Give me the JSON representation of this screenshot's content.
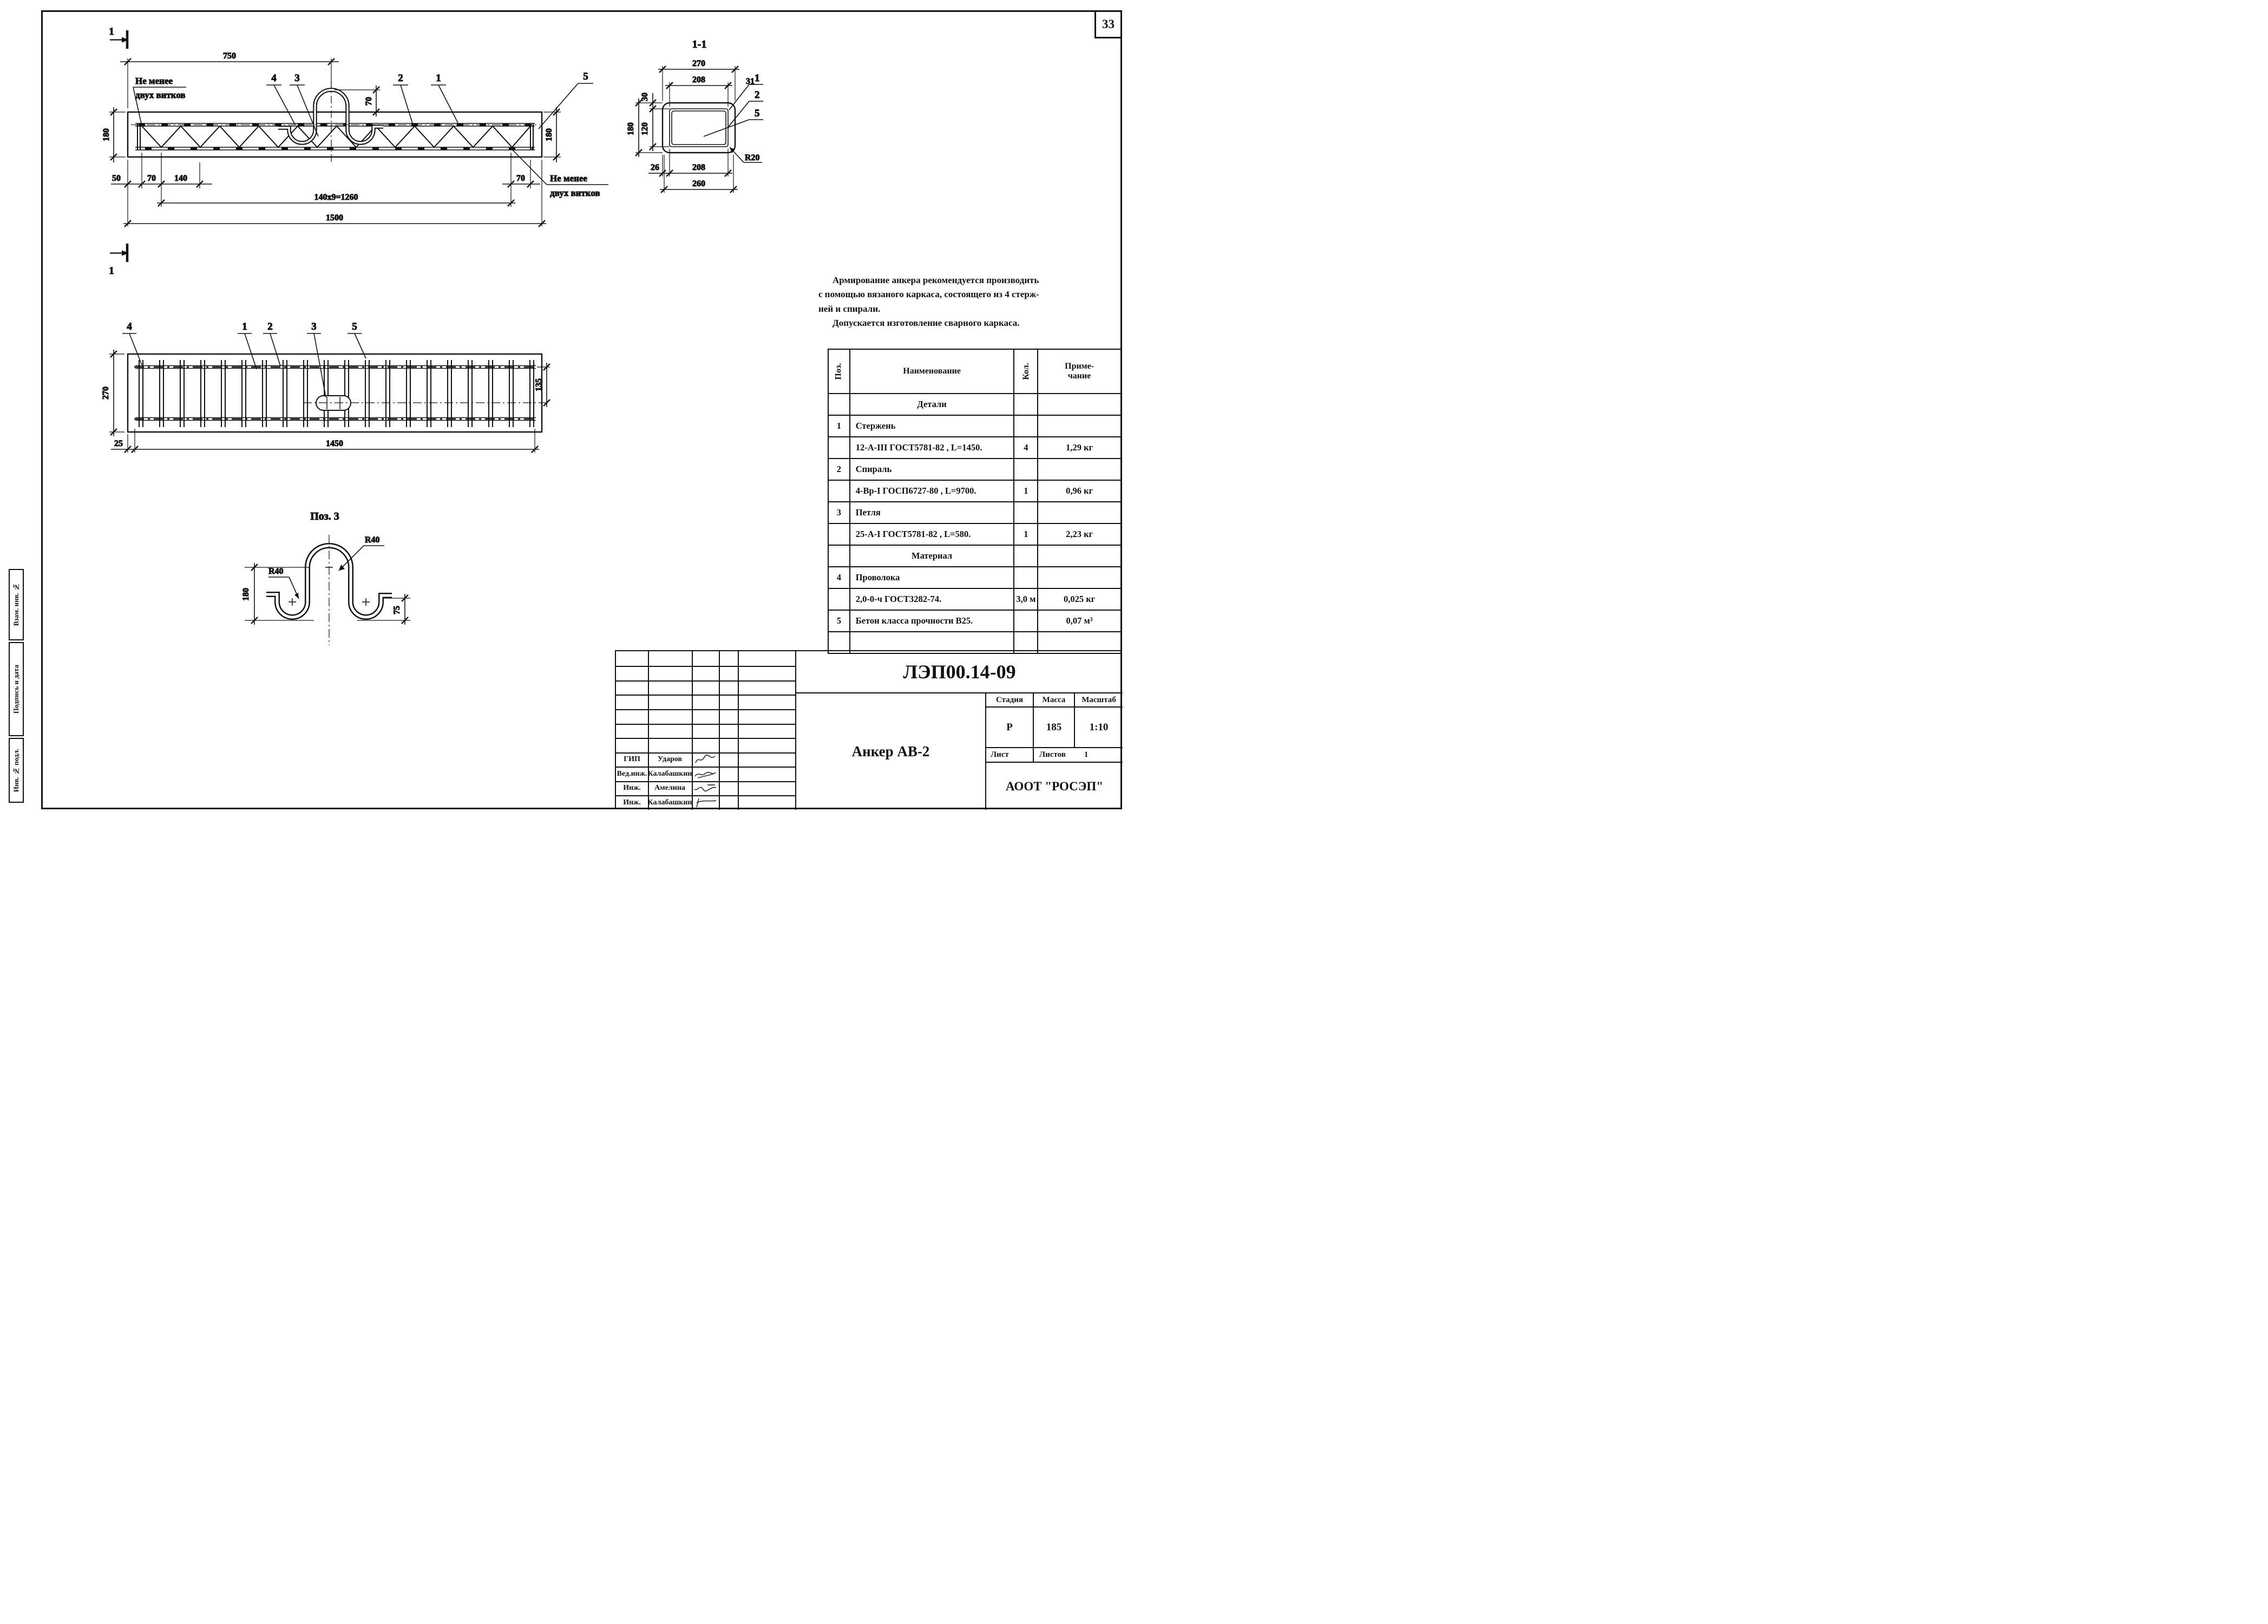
{
  "page": {
    "number": "33"
  },
  "margin_stamps": {
    "top": "Взам. инв. №",
    "middle": "Подпись и дата",
    "bottom": "Инв. № подл."
  },
  "side_view": {
    "section_mark": "1",
    "callouts": {
      "c1": "1",
      "c2": "2",
      "c3": "3",
      "c4": "4",
      "c5": "5"
    },
    "dims": {
      "width_top": "750",
      "loop_height": "70",
      "height_left": "180",
      "height_right": "180",
      "d50": "50",
      "d70_left": "70",
      "d140": "140",
      "d70_right": "70",
      "pitch": "140x9=1260",
      "total": "1500"
    },
    "note_left_1": "Не менее",
    "note_left_2": "двух витков",
    "note_right_1": "Не менее",
    "note_right_2": "двух витков"
  },
  "section_view": {
    "title": "1-1",
    "callouts": {
      "c1": "1",
      "c2": "2",
      "c5": "5"
    },
    "dims": {
      "w270": "270",
      "w208_top": "208",
      "o31": "31",
      "o30": "30",
      "h120": "120",
      "h180": "180",
      "o26": "26",
      "w208_bot": "208",
      "w260": "260",
      "r20": "R20"
    }
  },
  "plan_view": {
    "callouts": {
      "c1": "1",
      "c2": "2",
      "c3": "3",
      "c4": "4",
      "c5": "5"
    },
    "dims": {
      "h270": "270",
      "h135": "135",
      "d25": "25",
      "total": "1450"
    }
  },
  "detail_view": {
    "title": "Поз. 3",
    "dims": {
      "r40_top": "R40",
      "r40_left": "R40",
      "h180": "180",
      "h75": "75"
    }
  },
  "notes": {
    "lines": [
      "Армирование анкера рекомендуется производить",
      "с помощью вязаного каркаса, состоящего из 4 стерж-",
      "ней и спирали.",
      "Допускается изготовление сварного каркаса."
    ]
  },
  "spec_table": {
    "headers": {
      "pos": "Поз.",
      "name": "Наименование",
      "qty": "Кол.",
      "note1": "Приме-",
      "note2": "чание"
    },
    "rows": [
      {
        "pos": "",
        "name": "Детали",
        "qty": "",
        "note": ""
      },
      {
        "pos": "1",
        "name": "Стержень",
        "qty": "",
        "note": ""
      },
      {
        "pos": "",
        "name": "12-А-III ГОСТ5781-82 , L=1450.",
        "qty": "4",
        "note": "1,29 кг"
      },
      {
        "pos": "2",
        "name": "Спираль",
        "qty": "",
        "note": ""
      },
      {
        "pos": "",
        "name": "4-Вр-I ГОСП6727-80 , L=9700.",
        "qty": "1",
        "note": "0,96 кг"
      },
      {
        "pos": "3",
        "name": "Петля",
        "qty": "",
        "note": ""
      },
      {
        "pos": "",
        "name": "25-А-I ГОСТ5781-82 , L=580.",
        "qty": "1",
        "note": "2,23 кг"
      },
      {
        "pos": "",
        "name": "Материал",
        "qty": "",
        "note": ""
      },
      {
        "pos": "4",
        "name": "Проволока",
        "qty": "",
        "note": ""
      },
      {
        "pos": "",
        "name": "2,0-0-ч ГОСТ3282-74.",
        "qty": "3,0 м",
        "note": "0,025 кг"
      },
      {
        "pos": "5",
        "name": "Бетон класса прочности В25.",
        "qty": "",
        "note": "0,07 м³"
      },
      {
        "pos": "",
        "name": "",
        "qty": "",
        "note": ""
      }
    ]
  },
  "title_block": {
    "doc_number": "ЛЭП00.14-09",
    "title": "Анкер АВ-2",
    "stage_label": "Стадия",
    "mass_label": "Масса",
    "scale_label": "Масштаб",
    "stage": "Р",
    "mass": "185",
    "scale": "1:10",
    "sheet_label": "Лист",
    "sheets_label": "Листов",
    "sheets_value": "1",
    "company": "АООТ \"РОСЭП\"",
    "signatures": [
      {
        "role": "ГИП",
        "name": "Ударов"
      },
      {
        "role": "Вед.инж.",
        "name": "Калабашкин"
      },
      {
        "role": "Инж.",
        "name": "Амелина"
      },
      {
        "role": "Инж.",
        "name": "Калабашкин"
      }
    ]
  }
}
